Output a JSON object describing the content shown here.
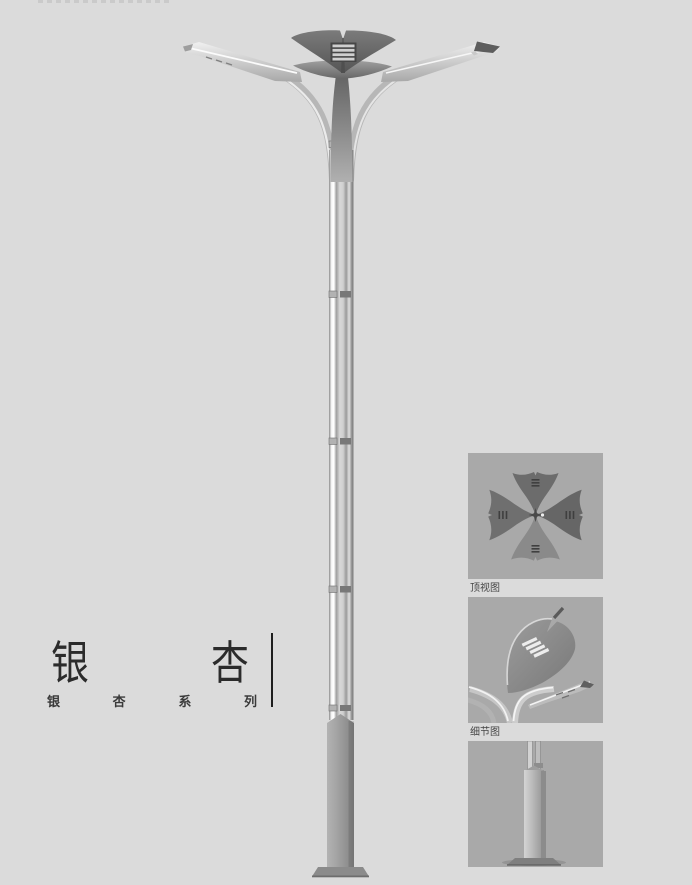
{
  "page": {
    "background": "#dbdbdb"
  },
  "title": {
    "main": "银杏",
    "main_chars": [
      "银",
      "杏"
    ],
    "sub": "银杏系列",
    "sub_chars": [
      "银",
      "杏",
      "系",
      "列"
    ]
  },
  "figures": [
    {
      "name": "top-view",
      "caption": "顶视图"
    },
    {
      "name": "detail-view",
      "caption": "细节图"
    },
    {
      "name": "base-view",
      "caption": ""
    }
  ],
  "illustration": {
    "subject": "ginkgo-leaf double-arm street lamp",
    "colors": {
      "panel_background": "#a9a9a9",
      "head_dark": "#5f5f5f",
      "metal_light": "#ececec",
      "metal_mid": "#b5b5b5",
      "metal_dark": "#7d7d7d",
      "text": "#2b2b2b"
    }
  }
}
